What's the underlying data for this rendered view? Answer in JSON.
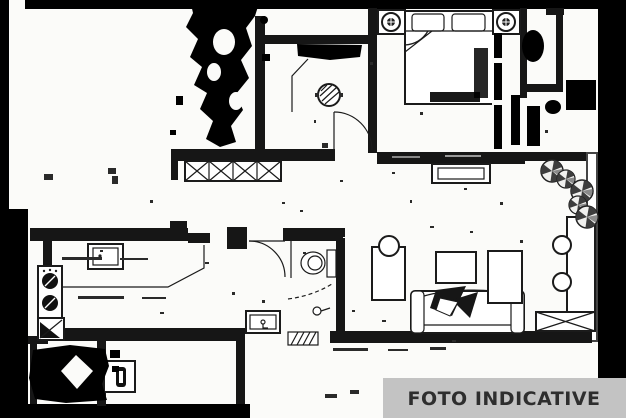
{
  "banner": {
    "label": "FOTO INDICATIVE",
    "bg_color": "#c3c3c3",
    "text_color": "#2e2e2e"
  },
  "palette": {
    "paper": "#fbfbf9",
    "ink": "#1b1b1b",
    "wall": "#161616",
    "scan_border": "#000000",
    "banner_gray": "#c3c3c3"
  },
  "plan": {
    "type": "scanned apartment floor plan",
    "rooms": {
      "bedroom": [
        "double-bed",
        "pillow-left",
        "pillow-right",
        "nightstand-lamp-left",
        "nightstand-lamp-right",
        "radiator"
      ],
      "corridor": [
        "ceiling-light",
        "door-swing",
        "built-in-wardrobe"
      ],
      "kitchen": [
        "counter",
        "sink",
        "stove-burners",
        "corner-cabinet"
      ],
      "bathroom": [
        "door-swing",
        "toilet",
        "shower-curtain",
        "washbasin",
        "floor-drain",
        "threshold-hatch"
      ],
      "living_room": [
        "side-table",
        "chair",
        "coffee-table",
        "sofa",
        "throw-pillows",
        "cabinet",
        "dining-table",
        "chair",
        "chair",
        "wardrobe-hatch"
      ],
      "balcony": [
        "door-fixture"
      ],
      "right_edge": [
        "fan-plant",
        "fan-plant",
        "fan-plant",
        "fan-plant",
        "fan-plant"
      ]
    }
  }
}
